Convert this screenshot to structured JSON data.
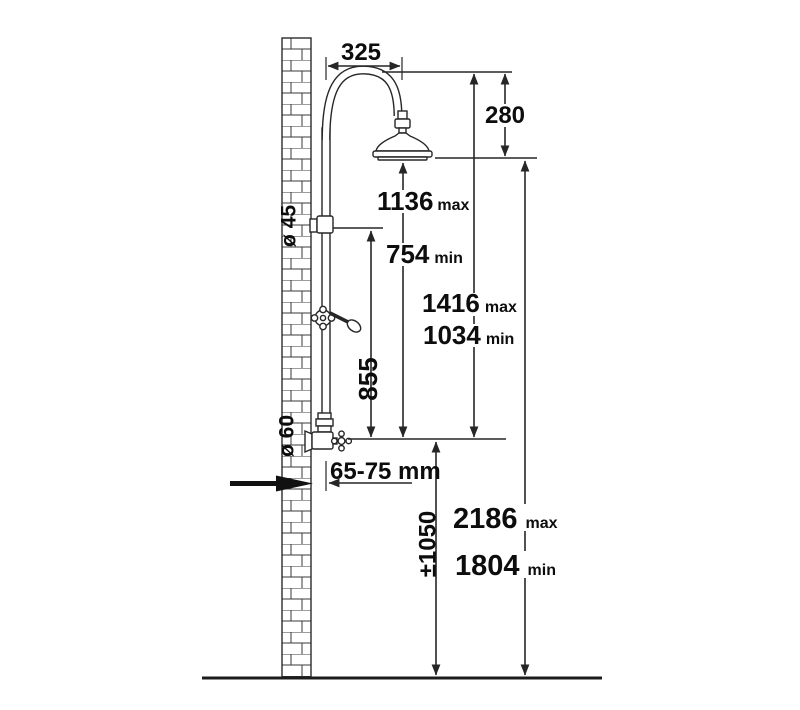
{
  "diagram": {
    "title": "Shower column installation dimension drawing",
    "colors": {
      "line": "#262626",
      "text": "#0d0d0d",
      "background": "#ffffff"
    },
    "dims": {
      "arm_width": {
        "value": "325"
      },
      "head_drop": {
        "value": "280"
      },
      "head_to_valve_max": {
        "value": "1136",
        "unit": "max"
      },
      "head_to_valve_min": {
        "value": "754",
        "unit": "min"
      },
      "arch_to_valve_max": {
        "value": "1416",
        "unit": "max"
      },
      "arch_to_valve_min": {
        "value": "1034",
        "unit": "min"
      },
      "riser_length": {
        "value": "855"
      },
      "bracket_diameter": {
        "value": "ø 45"
      },
      "valve_diameter": {
        "value": "ø 60"
      },
      "wall_distance": {
        "value": "65-75 mm"
      },
      "inlet_height": {
        "value": "±1050"
      },
      "overall_max": {
        "value": "2186",
        "unit": "max"
      },
      "overall_min": {
        "value": "1804",
        "unit": "min"
      }
    }
  }
}
